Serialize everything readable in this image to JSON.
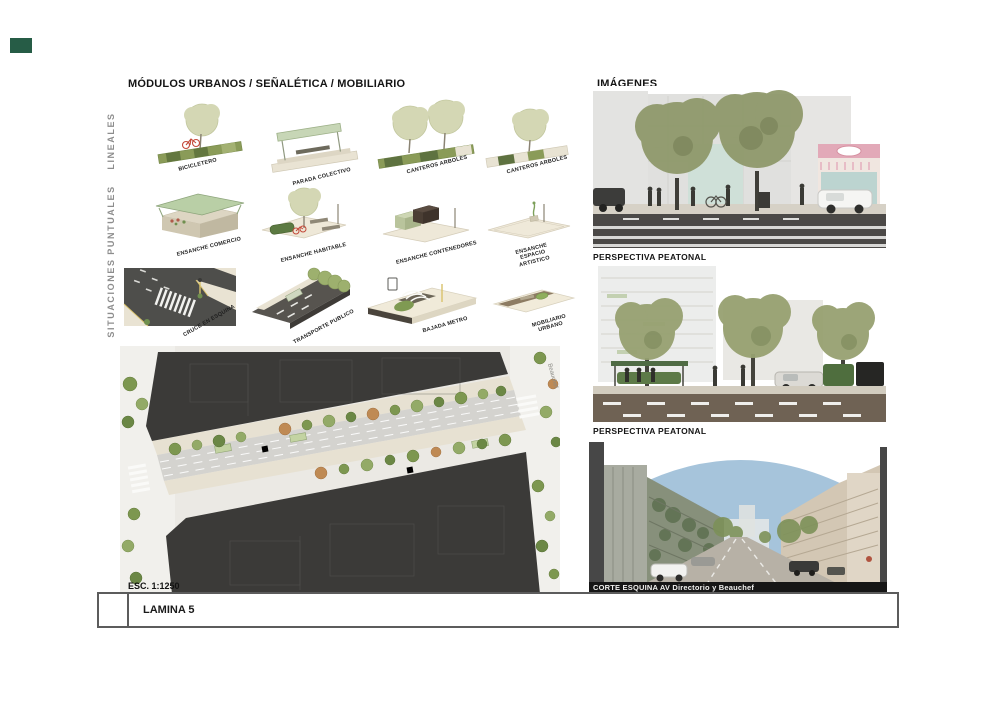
{
  "modules_panel": {
    "title": "MÓDULOS URBANOS / SEÑALÉTICA / MOBILIARIO",
    "row_labels": [
      "LINEALES",
      "PUNTUALES",
      "SITUACIONES"
    ],
    "items": {
      "bicicletero": "BICICLETERO",
      "parada_colectivo": "PARADA COLECTIVO",
      "canteros_arboles_1": "CANTEROS ARBOLES",
      "canteros_arboles_2": "CANTEROS ARBOLES",
      "ensanche_comercio": "ENSANCHE COMERCIO",
      "ensanche_habitable": "ENSANCHE HABITABLE",
      "ensanche_contenedores": "ENSANCHE CONTENEDORES",
      "ensanche_espacio_artistico": "ENSANCHE ESPACIO ARTISTICO",
      "cruce_en_esquina": "CRUCE EN ESQUINA",
      "transporte_publico": "TRANSPORTE PUBLICO",
      "bajada_metro": "BAJADA METRO",
      "mobiliario_urbano": "MOBILIARIO URBANO"
    }
  },
  "site_plan": {
    "scale_label": "ESC. 1:1250",
    "street_label": "Beauchef"
  },
  "images_panel": {
    "title": "IMÁGENES",
    "caption_1": "PERSPECTIVA PEATONAL",
    "caption_2": "PERSPECTIVA PEATONAL",
    "caption_3": "CORTE ESQUINA AV Directorio y Beauchef"
  },
  "title_block": {
    "label": "LAMINA 5"
  },
  "colors": {
    "logo_green": "#265c46",
    "plan_building": "#3b3a38",
    "sky_blue": "#a6c4db",
    "tree_pale": "#d4d7b4",
    "tree_olive": "#8f9a6b"
  }
}
